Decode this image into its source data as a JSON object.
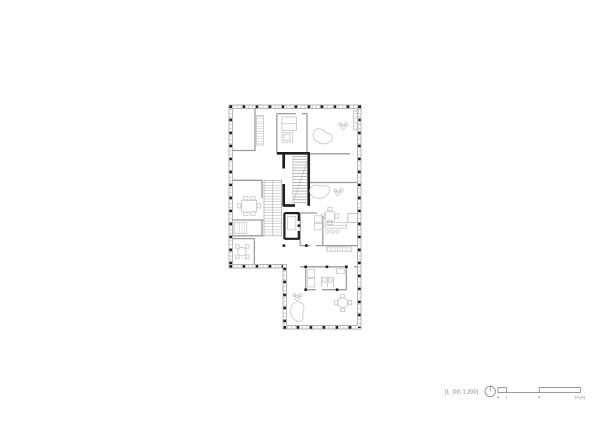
{
  "annotation": {
    "label": "[1. OG 1:200]"
  },
  "scale_bar": {
    "marks": [
      "0",
      "1",
      "5",
      "10 (m)"
    ]
  },
  "colors": {
    "wall": "#9c9c9c",
    "mullion": "#bdbdbd",
    "core": "#1f1f1f",
    "furniture": "#c6c6c6",
    "tread": "#b2b2b2",
    "tread-dark": "#8f8f8f",
    "annotation": "#787878",
    "background": "#ffffff"
  }
}
